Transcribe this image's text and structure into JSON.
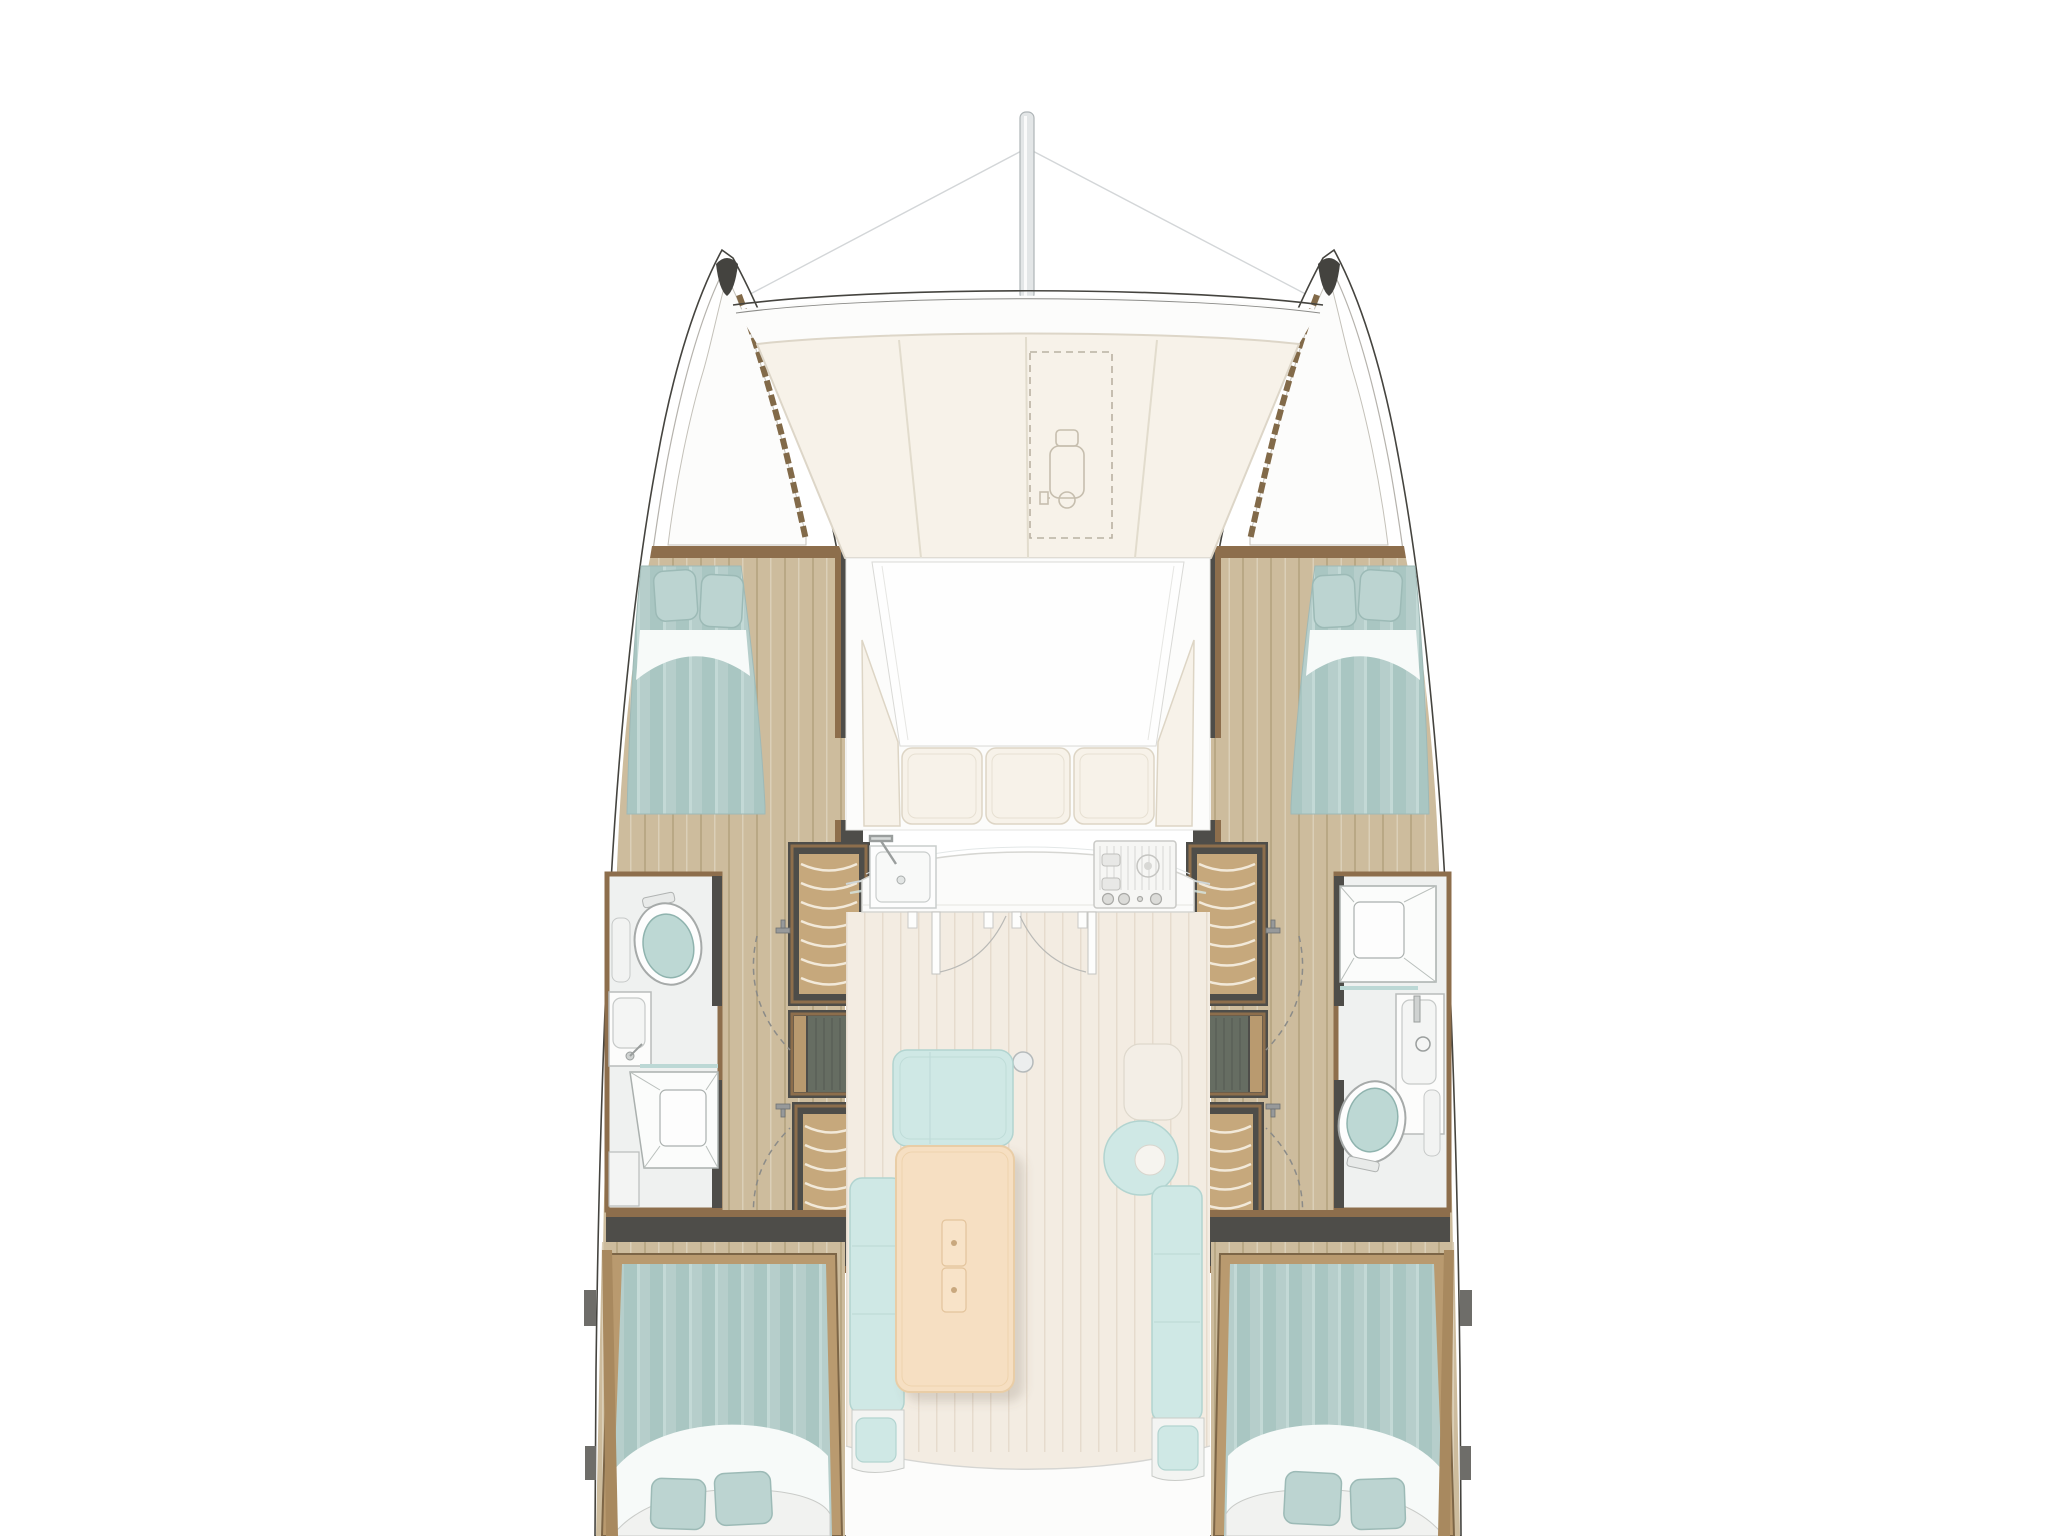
{
  "title": "Catamaran interior layout — overhead floor plan, bow up",
  "diagram": {
    "type": "boat-floorplan",
    "orientation": "bow-up",
    "cabins": 4,
    "heads": 2,
    "double_berths": 4,
    "stove_burner_knobs": 3
  },
  "rooms": [
    {
      "id": "port-forward-cabin",
      "label": "Port forward cabin with double berth"
    },
    {
      "id": "starboard-forward-cabin",
      "label": "Starboard forward cabin with double berth"
    },
    {
      "id": "port-head",
      "label": "Port head: toilet, vanity sink, shower"
    },
    {
      "id": "starboard-head",
      "label": "Starboard head: shower, vanity sink, toilet"
    },
    {
      "id": "port-aft-cabin",
      "label": "Port aft cabin with double berth"
    },
    {
      "id": "starboard-aft-cabin",
      "label": "Starboard aft cabin with double berth"
    },
    {
      "id": "saloon",
      "label": "Saloon with dining table, sofa and bench"
    },
    {
      "id": "galley",
      "label": "Galley with sink and 3-burner stove"
    },
    {
      "id": "forward-cockpit",
      "label": "Forward cockpit with U-shaped seating"
    },
    {
      "id": "foredeck",
      "label": "Foredeck sunpads with anchor-windlass hatch"
    },
    {
      "id": "anchor-lockers",
      "label": "Bow anchor lockers"
    }
  ],
  "colors": {
    "outline": "#45443f",
    "charcoal": "#4e4d49",
    "woodTrim": "#8d6e4c",
    "woodTrimLight": "#b99a6f",
    "floorWood": "#cdbc9d",
    "floorPlank": "#b9a885",
    "bedding": "#b6cecb",
    "beddingStripe": "#a9c6c2",
    "pillow": "#bcd4d1",
    "sheet": "#f7faf9",
    "bathFloor": "#eff1f0",
    "fixtureOutline": "#a6aaa9",
    "toiletLid": "#bdd8d4",
    "tambour": "#c6a87c",
    "tambourLine": "#f2e9d9",
    "darkWood": "#666d62",
    "saloonFloor": "#f3ece2",
    "cushion": "#f7f2e9",
    "cushionSeam": "#ddd5c5",
    "sofa": "#cfe8e5",
    "sofaSeam": "#b2d4d0",
    "table": "#f6dfc2",
    "tableEdge": "#e9cda6",
    "counter": "#fbfbfa",
    "counterEdge": "#d6d6d2",
    "mast": "#e3e6e7",
    "rigging": "#d3d6d8",
    "hatchDash": "#b9b1a2",
    "deckWhite": "#fcfcfb",
    "windowLine": "#cfd6d7",
    "aftDeck": "#fcfcfb",
    "tabGray": "#6e6d69"
  }
}
